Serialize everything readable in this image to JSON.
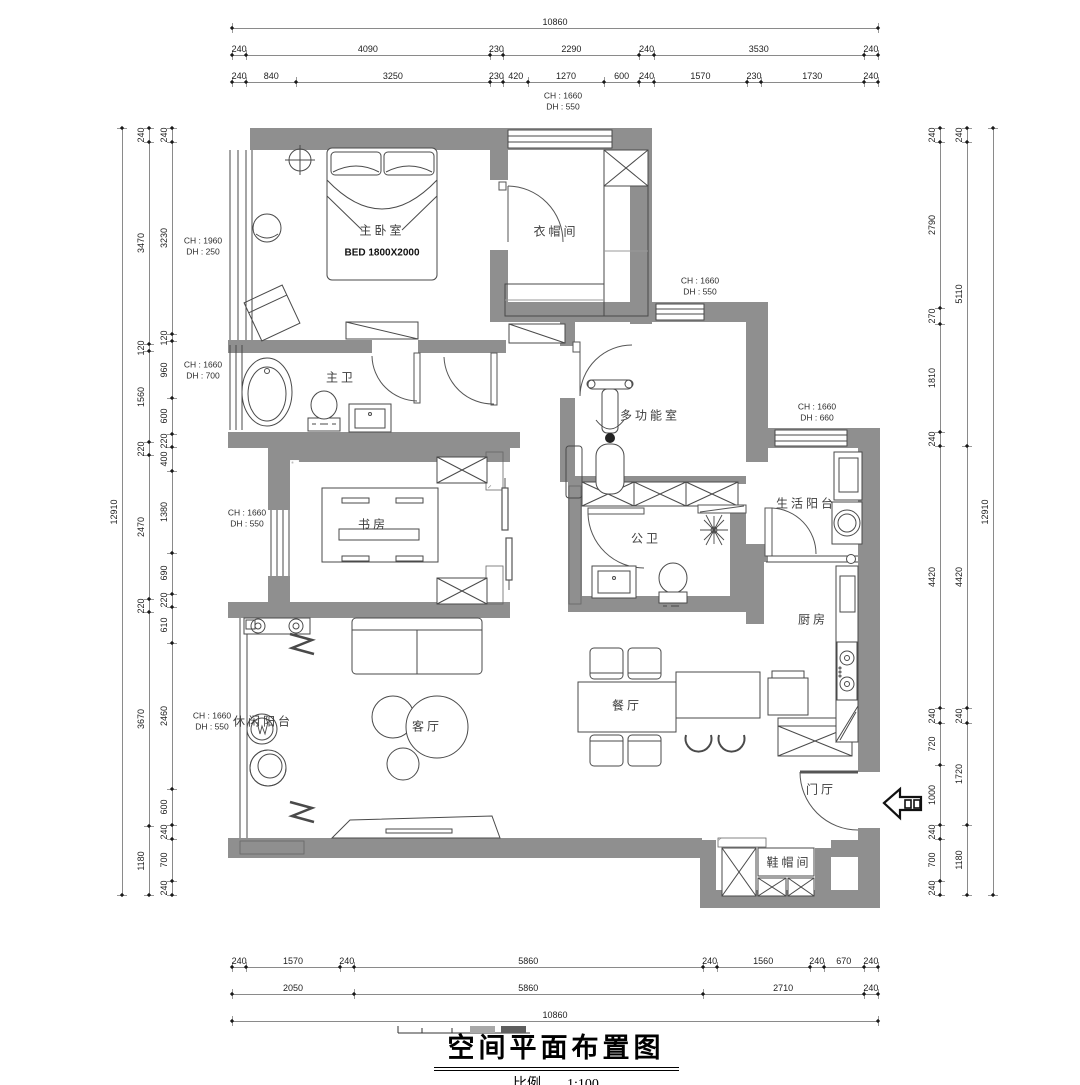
{
  "title": {
    "text": "空间平面布置图",
    "scale_label": "比例",
    "scale_value": "1:100"
  },
  "rooms": [
    {
      "name": "room-label-master-bedroom",
      "label": "主卧室",
      "x": 382,
      "y": 230
    },
    {
      "name": "room-label-cloakroom",
      "label": "衣帽间",
      "x": 556,
      "y": 231
    },
    {
      "name": "room-label-master-bath",
      "label": "主卫",
      "x": 341,
      "y": 377
    },
    {
      "name": "room-label-study",
      "label": "书房",
      "x": 373,
      "y": 524
    },
    {
      "name": "room-label-multi-function",
      "label": "多功能室",
      "x": 650,
      "y": 415
    },
    {
      "name": "room-label-guest-bath",
      "label": "公卫",
      "x": 646,
      "y": 538
    },
    {
      "name": "room-label-service-balcony",
      "label": "生活阳台",
      "x": 806,
      "y": 503
    },
    {
      "name": "room-label-kitchen",
      "label": "厨房",
      "x": 813,
      "y": 619
    },
    {
      "name": "room-label-dining",
      "label": "餐厅",
      "x": 627,
      "y": 705
    },
    {
      "name": "room-label-living",
      "label": "客厅",
      "x": 427,
      "y": 726
    },
    {
      "name": "room-label-leisure-balcony",
      "label": "休闲阳台",
      "x": 263,
      "y": 721
    },
    {
      "name": "room-label-foyer",
      "label": "门厅",
      "x": 821,
      "y": 789
    },
    {
      "name": "room-label-shoe-room",
      "label": "鞋帽间",
      "x": 789,
      "y": 862
    }
  ],
  "bed_note": {
    "label": "BED 1800X2000",
    "x": 382,
    "y": 253
  },
  "annotations": [
    {
      "name": "ann-top-window",
      "x": 563,
      "y": 102,
      "lines": [
        "CH : 1660",
        "DH : 550"
      ]
    },
    {
      "name": "ann-bedroom-window",
      "x": 203,
      "y": 247,
      "lines": [
        "CH : 1960",
        "DH : 250"
      ]
    },
    {
      "name": "ann-masterbath-window",
      "x": 203,
      "y": 371,
      "lines": [
        "CH : 1660",
        "DH : 700"
      ]
    },
    {
      "name": "ann-study-window",
      "x": 247,
      "y": 519,
      "lines": [
        "CH : 1660",
        "DH : 550"
      ]
    },
    {
      "name": "ann-leisure-window",
      "x": 212,
      "y": 722,
      "lines": [
        "CH : 1660",
        "DH : 550"
      ]
    },
    {
      "name": "ann-multi-window",
      "x": 700,
      "y": 287,
      "lines": [
        "CH : 1660",
        "DH : 550"
      ]
    },
    {
      "name": "ann-service-window",
      "x": 817,
      "y": 413,
      "lines": [
        "CH : 1660",
        "DH : 660"
      ]
    }
  ],
  "dimensions": {
    "horizontal": [
      {
        "name": "dim-top-overall",
        "y": 28,
        "x1": 232,
        "x2": 878,
        "values": [
          10860
        ]
      },
      {
        "name": "dim-top-row2",
        "y": 55,
        "x1": 232,
        "x2": 878,
        "values": [
          240,
          4090,
          230,
          2290,
          240,
          3530,
          240
        ]
      },
      {
        "name": "dim-top-row3",
        "y": 82,
        "x1": 232,
        "x2": 878,
        "values": [
          240,
          840,
          3250,
          230,
          420,
          1270,
          600,
          240,
          1570,
          230,
          1730,
          240
        ]
      },
      {
        "name": "dim-bottom-row1",
        "y": 967,
        "x1": 232,
        "x2": 878,
        "values": [
          240,
          1570,
          240,
          5860,
          240,
          1560,
          240,
          670,
          240
        ]
      },
      {
        "name": "dim-bottom-row2",
        "y": 994,
        "x1": 232,
        "x2": 878,
        "values": [
          2050,
          5860,
          2710,
          240
        ]
      },
      {
        "name": "dim-bottom-overall",
        "y": 1021,
        "x1": 232,
        "x2": 878,
        "values": [
          10860
        ]
      }
    ],
    "vertical": [
      {
        "name": "dim-left-overall",
        "x": 122,
        "y1": 128,
        "y2": 895,
        "values": [
          12910
        ]
      },
      {
        "name": "dim-left-col2",
        "x": 149,
        "y1": 128,
        "y2": 895,
        "values": [
          240,
          3470,
          120,
          1560,
          220,
          2470,
          220,
          3670,
          1180
        ]
      },
      {
        "name": "dim-left-col3",
        "x": 172,
        "y1": 128,
        "y2": 895,
        "values": [
          240,
          3230,
          120,
          960,
          600,
          220,
          400,
          1380,
          690,
          220,
          610,
          2460,
          600,
          240,
          700,
          240
        ]
      },
      {
        "name": "dim-right-col1",
        "x": 940,
        "y1": 128,
        "y2": 895,
        "values": [
          240,
          2790,
          270,
          1810,
          240,
          4420,
          240,
          720,
          1000,
          240,
          700,
          240
        ]
      },
      {
        "name": "dim-right-col2",
        "x": 967,
        "y1": 128,
        "y2": 895,
        "values": [
          240,
          5110,
          4420,
          240,
          1720,
          1180
        ]
      },
      {
        "name": "dim-right-overall",
        "x": 993,
        "y1": 128,
        "y2": 895,
        "values": [
          12910
        ]
      }
    ]
  },
  "colors": {
    "wall": "#8f8f8f",
    "line": "#4a4a4a",
    "dim": "#8a8a8a"
  }
}
